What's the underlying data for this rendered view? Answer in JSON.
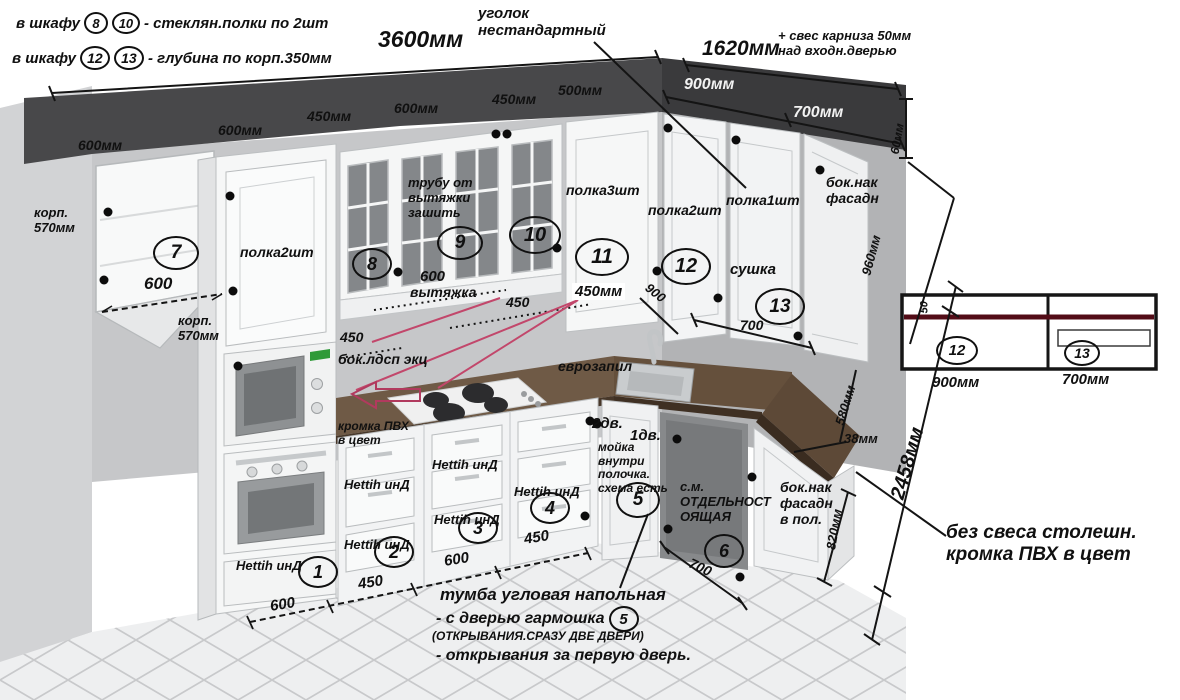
{
  "palette": {
    "maroon_line": "#530c17",
    "annotation_pink": "#c2476b",
    "wood_top": "#6f5a46",
    "dark_band": "#48484a",
    "wall": "#c6c7c9",
    "floor": "#eeeff0"
  },
  "header_notes": {
    "note1": {
      "prefix": "в шкафу",
      "c1": "8",
      "c2": "10",
      "suffix": "- стеклян.полки по 2шт"
    },
    "note2": {
      "prefix": "в шкафу",
      "c1": "12",
      "c2": "13",
      "suffix": "- глубина по корп.350мм"
    },
    "corner": "уголок\nнестандартный",
    "cornice": "+ свес карниза 50мм\nнад входн.дверью"
  },
  "dims": {
    "top_width": "3600мм",
    "right_width": "1620мм",
    "d900": "900мм",
    "d700": "700мм",
    "row": [
      "600мм",
      "600мм",
      "450мм",
      "600мм",
      "450мм",
      "500мм"
    ],
    "d60": "60мм",
    "d960": "960мм",
    "d580": "580мм",
    "d38": "38мм",
    "d820": "820мм",
    "d2458": "2458мм",
    "shelf600": "600",
    "hood600": "600",
    "mid450mm": "450мм",
    "mid450a": "450",
    "mid450b": "450",
    "rot900": "900",
    "mid700": "700",
    "rot700": "700",
    "bottom": [
      "600",
      "450",
      "600",
      "450"
    ]
  },
  "cabinet_labels": {
    "korp570a": "корп.\n570мм",
    "korp570b": "корп.\n570мм",
    "polka2a": "полка2шт",
    "polka3": "полка3шт",
    "polka2b": "полка2шт",
    "polka1": "полка1шт",
    "duct": "трубу от\nвытяжки\nзашить",
    "hood": "вытяжка",
    "boknak": "бок.нак\nфасадн",
    "sushka": "сушка",
    "bok_ldsp": "бок.лдсп экц",
    "evrozapil": "еврозапил",
    "kromka": "кромка ПВХ\nв цвет",
    "dv2": "2дв.",
    "dv1": "1дв.",
    "moika": "мойка\nвнутри\nполочка.\nсхема есть",
    "sm": "с.м.\nОТДЕЛЬНОСТ\nОЯЩАЯ",
    "boknak_pol": "бок.нак\nфасадн\nв пол.",
    "hettih": "Hettih инД"
  },
  "callouts": {
    "n1": "1",
    "n2": "2",
    "n3": "3",
    "n4": "4",
    "n5": "5",
    "n6": "6",
    "n7": "7",
    "n8": "8",
    "n9": "9",
    "n10": "10",
    "n11": "11",
    "n12": "12",
    "n13": "13"
  },
  "footnotes": {
    "corner_base_l1": "тумба угловая напольная",
    "corner_base_l2": "- с дверью гармошка",
    "corner_base_l3": "(ОТКРЫВАНИЯ.СРАЗУ ДВЕ ДВЕРИ)",
    "corner_base_l4": "- открывания за первую дверь.",
    "no_overhang": "без свеса столешн.\nкромка ПВХ в цвет"
  },
  "detail_box": {
    "t50": "50",
    "c12": "12",
    "c13": "13",
    "w_left": "900мм",
    "w_right": "700мм"
  }
}
